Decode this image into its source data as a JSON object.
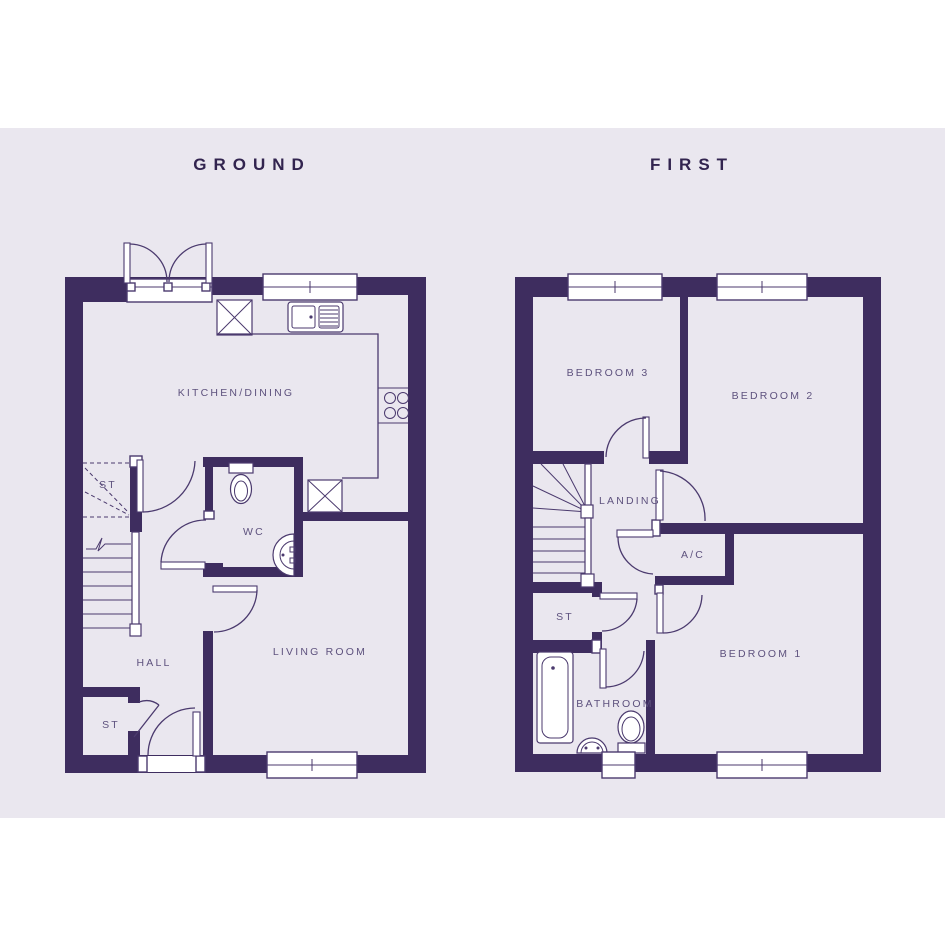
{
  "colors": {
    "page": "#ffffff",
    "canvas": "#eae7ef",
    "wall": "#3e2d5f",
    "line": "#4b3a6e",
    "title": "#32244f",
    "label": "#5e527e",
    "window_fill": "#ffffff"
  },
  "floors": {
    "ground": {
      "title": "GROUND",
      "rooms": {
        "kitchen_dining": "KITCHEN/DINING",
        "stairs_store": "ST",
        "wc": "WC",
        "hall": "HALL",
        "living_room": "LIVING ROOM",
        "hall_store": "ST"
      }
    },
    "first": {
      "title": "FIRST",
      "rooms": {
        "bedroom3": "BEDROOM 3",
        "bedroom2": "BEDROOM 2",
        "landing": "LANDING",
        "airing_cupboard": "A/C",
        "store": "ST",
        "bedroom1": "BEDROOM 1",
        "bathroom": "BATHROOM"
      }
    }
  }
}
